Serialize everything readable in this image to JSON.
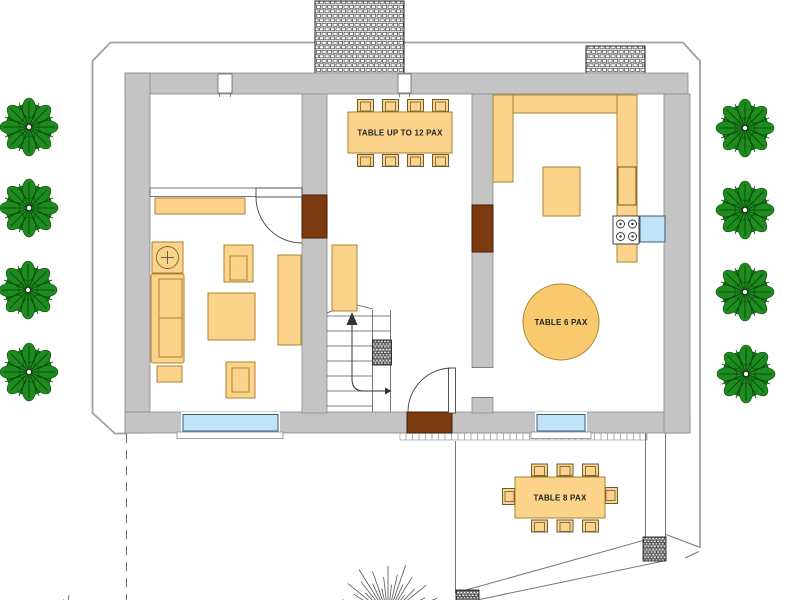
{
  "labels": {
    "table_large": "TABLE UP TO 12 PAX",
    "table_round": "TABLE 6 PAX",
    "table_terrace": "TABLE 8 PAX"
  },
  "palette": {
    "wall_fill": "#C4C4C4",
    "wall_stroke": "#8A8A8A",
    "furniture_fill": "#FBD38B",
    "furniture_stroke": "#A8832F",
    "door_brown": "#7B3A10",
    "window_blue": "#BFE3F7",
    "tree_green": "#1E8B1E",
    "boundary_gray": "#A0A0A0"
  },
  "plan": {
    "type": "floor-plan",
    "rooms": [
      {
        "name": "upper-left-room",
        "furniture": []
      },
      {
        "name": "living-room",
        "furniture": [
          "sideboard",
          "side-table",
          "armchair",
          "armchair",
          "sofa",
          "ottoman",
          "coffee-table",
          "console"
        ]
      },
      {
        "name": "hall",
        "furniture": [
          "dining-table-12-pax",
          "8-chairs",
          "console",
          "staircase"
        ]
      },
      {
        "name": "kitchen-dining",
        "furniture": [
          "u-shaped-counter",
          "island",
          "stove",
          "sink-unit",
          "round-table-6-pax"
        ]
      },
      {
        "name": "terrace",
        "furniture": [
          "outdoor-table-8-pax",
          "8-chairs"
        ]
      }
    ],
    "door_count": 3,
    "window_count": 5,
    "tree_count": 8,
    "chimney_count": 2
  }
}
